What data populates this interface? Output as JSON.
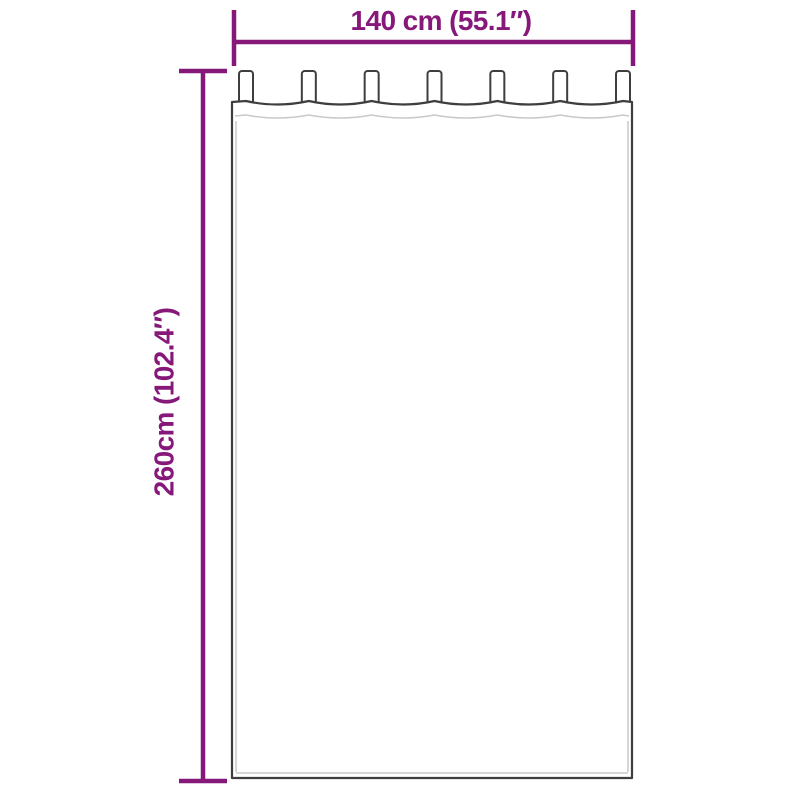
{
  "diagram": {
    "width_label": "140 cm (55.1″)",
    "height_label": "260cm (102.4″)",
    "tabs_count": 7,
    "colors": {
      "accent": "#86187A",
      "outline": "#3E3E3E",
      "seam": "#C9C9C9",
      "background": "#FFFFFF"
    }
  }
}
